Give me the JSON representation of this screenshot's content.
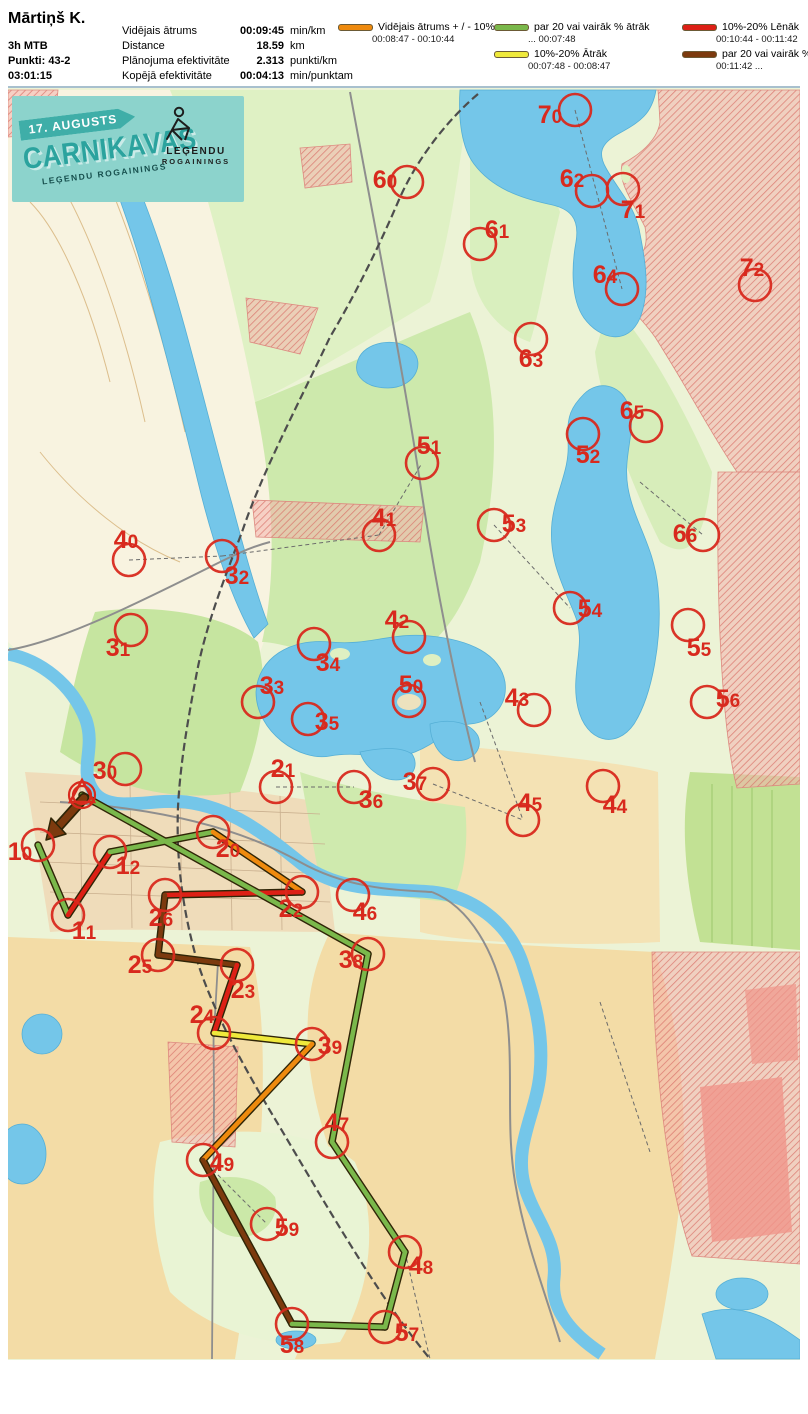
{
  "header": {
    "title": "Mārtiņš K.",
    "class": "3h MTB",
    "points": "Punkti: 43-2",
    "time": "03:01:15",
    "stats": [
      {
        "label": "Vidējais ātrums",
        "value": "00:09:45",
        "unit": "min/km"
      },
      {
        "label": "Distance",
        "value": "18.59",
        "unit": "km"
      },
      {
        "label": "Plānojuma efektivitāte",
        "value": "2.313",
        "unit": "punkti/km"
      },
      {
        "label": "Kopējā efektivitāte",
        "value": "00:04:13",
        "unit": "min/punktam"
      }
    ]
  },
  "legend": {
    "items": [
      {
        "col": 1,
        "color": "#EE8A0E",
        "label": "Vidējais ātrums + / - 10%",
        "range": "00:08:47   -   00:10:44"
      },
      {
        "col": 2,
        "color": "#7AB84B",
        "label": "par 20 vai vairāk % ātrāk",
        "range": "...    00:07:48"
      },
      {
        "col": 2,
        "color": "#EFE93B",
        "label": "10%-20% Ātrāk",
        "range": "00:07:48   -   00:08:47"
      },
      {
        "col": 3,
        "color": "#DD2015",
        "label": "10%-20% Lēnāk",
        "range": "00:10:44   - 00:11:42"
      },
      {
        "col": 3,
        "color": "#7C3A0E",
        "label": "par 20 vai vairāk % lēnāk",
        "range": "00:11:42   ..."
      }
    ]
  },
  "map": {
    "banner": {
      "date": "17. AUGUSTS",
      "title": "CARNIKAVAS",
      "subtitle": "LEĢENDU ROGAININGS",
      "logo_line1": "LEĢENDU",
      "logo_line2": "ROGAININGS"
    },
    "colors": {
      "control": "#D8291D",
      "water": "#74C6E9",
      "route_outline": "#2F2507"
    },
    "pace_colors": {
      "green": "#7AB84B",
      "yellow": "#EFE93B",
      "orange": "#EE8A0E",
      "red": "#DD2015",
      "brown": "#7C3A0E"
    },
    "start": {
      "x": 82,
      "y": 793
    },
    "finish_arrow": {
      "from": [
        84,
        796
      ],
      "to": [
        58,
        825
      ],
      "tip": [
        46,
        838
      ],
      "wing1": [
        66,
        832
      ],
      "wing2": [
        51,
        816
      ],
      "pace": "brown"
    },
    "controls": [
      {
        "id": "70",
        "x": 575,
        "y": 108,
        "lx": 550,
        "ly": 112
      },
      {
        "id": "60",
        "x": 407,
        "y": 180,
        "lx": 385,
        "ly": 177
      },
      {
        "id": "61",
        "x": 480,
        "y": 242,
        "lx": 497,
        "ly": 227
      },
      {
        "id": "62",
        "x": 592,
        "y": 189,
        "lx": 572,
        "ly": 176
      },
      {
        "id": "71",
        "x": 623,
        "y": 187,
        "lx": 633,
        "ly": 207
      },
      {
        "id": "64",
        "x": 622,
        "y": 287,
        "lx": 605,
        "ly": 272
      },
      {
        "id": "72",
        "x": 755,
        "y": 283,
        "lx": 752,
        "ly": 265
      },
      {
        "id": "63",
        "x": 531,
        "y": 337,
        "lx": 531,
        "ly": 356
      },
      {
        "id": "65",
        "x": 646,
        "y": 424,
        "lx": 632,
        "ly": 408
      },
      {
        "id": "51",
        "x": 422,
        "y": 461,
        "lx": 429,
        "ly": 443
      },
      {
        "id": "52",
        "x": 583,
        "y": 432,
        "lx": 588,
        "ly": 452
      },
      {
        "id": "40",
        "x": 129,
        "y": 558,
        "lx": 126,
        "ly": 537
      },
      {
        "id": "32",
        "x": 222,
        "y": 554,
        "lx": 237,
        "ly": 573
      },
      {
        "id": "41",
        "x": 379,
        "y": 533,
        "lx": 384,
        "ly": 515
      },
      {
        "id": "53",
        "x": 494,
        "y": 523,
        "lx": 514,
        "ly": 521
      },
      {
        "id": "66",
        "x": 703,
        "y": 533,
        "lx": 685,
        "ly": 531
      },
      {
        "id": "31",
        "x": 131,
        "y": 628,
        "lx": 118,
        "ly": 645
      },
      {
        "id": "34",
        "x": 314,
        "y": 642,
        "lx": 328,
        "ly": 660
      },
      {
        "id": "42",
        "x": 409,
        "y": 635,
        "lx": 397,
        "ly": 617
      },
      {
        "id": "54",
        "x": 570,
        "y": 606,
        "lx": 590,
        "ly": 606
      },
      {
        "id": "55",
        "x": 688,
        "y": 623,
        "lx": 699,
        "ly": 645
      },
      {
        "id": "33",
        "x": 258,
        "y": 700,
        "lx": 272,
        "ly": 683
      },
      {
        "id": "50",
        "x": 409,
        "y": 699,
        "lx": 411,
        "ly": 682
      },
      {
        "id": "56",
        "x": 707,
        "y": 700,
        "lx": 728,
        "ly": 696
      },
      {
        "id": "35",
        "x": 308,
        "y": 717,
        "lx": 327,
        "ly": 719
      },
      {
        "id": "43",
        "x": 534,
        "y": 708,
        "lx": 517,
        "ly": 695
      },
      {
        "id": "30",
        "x": 125,
        "y": 767,
        "lx": 105,
        "ly": 768
      },
      {
        "id": "21",
        "x": 276,
        "y": 785,
        "lx": 283,
        "ly": 766
      },
      {
        "id": "36",
        "x": 354,
        "y": 785,
        "lx": 371,
        "ly": 797
      },
      {
        "id": "37",
        "x": 433,
        "y": 782,
        "lx": 415,
        "ly": 779
      },
      {
        "id": "45",
        "x": 523,
        "y": 818,
        "lx": 530,
        "ly": 800
      },
      {
        "id": "44",
        "x": 603,
        "y": 784,
        "lx": 615,
        "ly": 802
      },
      {
        "id": "10",
        "x": 38,
        "y": 843,
        "lx": 20,
        "ly": 849
      },
      {
        "id": "12",
        "x": 110,
        "y": 850,
        "lx": 128,
        "ly": 863
      },
      {
        "id": "20",
        "x": 213,
        "y": 830,
        "lx": 228,
        "ly": 846
      },
      {
        "id": "22",
        "x": 302,
        "y": 890,
        "lx": 291,
        "ly": 906
      },
      {
        "id": "46",
        "x": 353,
        "y": 893,
        "lx": 365,
        "ly": 909
      },
      {
        "id": "11",
        "x": 68,
        "y": 913,
        "lx": 84,
        "ly": 928
      },
      {
        "id": "26",
        "x": 165,
        "y": 893,
        "lx": 161,
        "ly": 915
      },
      {
        "id": "25",
        "x": 158,
        "y": 953,
        "lx": 140,
        "ly": 962
      },
      {
        "id": "38",
        "x": 368,
        "y": 952,
        "lx": 351,
        "ly": 957
      },
      {
        "id": "23",
        "x": 237,
        "y": 963,
        "lx": 243,
        "ly": 987
      },
      {
        "id": "24",
        "x": 214,
        "y": 1031,
        "lx": 202,
        "ly": 1012
      },
      {
        "id": "39",
        "x": 312,
        "y": 1042,
        "lx": 330,
        "ly": 1043
      },
      {
        "id": "47",
        "x": 332,
        "y": 1140,
        "lx": 337,
        "ly": 1120
      },
      {
        "id": "49",
        "x": 203,
        "y": 1158,
        "lx": 222,
        "ly": 1160
      },
      {
        "id": "59",
        "x": 267,
        "y": 1222,
        "lx": 287,
        "ly": 1225
      },
      {
        "id": "48",
        "x": 405,
        "y": 1250,
        "lx": 421,
        "ly": 1263
      },
      {
        "id": "58",
        "x": 292,
        "y": 1322,
        "lx": 292,
        "ly": 1342
      },
      {
        "id": "57",
        "x": 385,
        "y": 1325,
        "lx": 407,
        "ly": 1330
      }
    ],
    "route": [
      {
        "a": "10",
        "b": "11",
        "pace": "green"
      },
      {
        "a": "11",
        "b": "12",
        "pace": "red"
      },
      {
        "a": "12",
        "b": "20",
        "pace": "green"
      },
      {
        "a": "20",
        "b": "22",
        "pace": "orange"
      },
      {
        "a": "22",
        "b": "26",
        "pace": "red"
      },
      {
        "a": "26",
        "b": "25",
        "pace": "brown"
      },
      {
        "a": "25",
        "b": "23",
        "pace": "brown"
      },
      {
        "a": "23",
        "b": "24",
        "pace": "red"
      },
      {
        "a": "24",
        "b": "39",
        "pace": "yellow"
      },
      {
        "a": "39",
        "b": "49",
        "pace": "orange"
      },
      {
        "a": "49",
        "b": "58",
        "pace": "brown"
      },
      {
        "a": "58",
        "b": "57",
        "pace": "green"
      },
      {
        "a": "57",
        "b": "48",
        "pace": "green"
      },
      {
        "a": "48",
        "b": "47",
        "pace": "green"
      },
      {
        "a": "47",
        "b": "38",
        "pace": "green"
      },
      {
        "a": "38",
        "b": "START",
        "pace": "green"
      }
    ]
  }
}
